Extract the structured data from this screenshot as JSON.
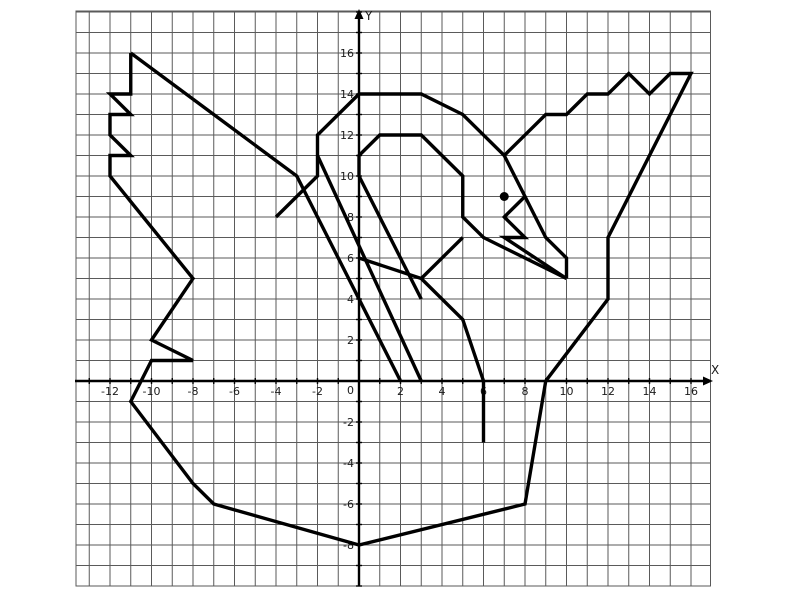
{
  "figure": {
    "width": 800,
    "height": 600,
    "background": "#ffffff",
    "drawing_color": "#000000",
    "grid_color": "#5a5a5a",
    "axis_color": "#000000",
    "label_color": "#1a1a1a"
  },
  "chart_data": {
    "type": "line",
    "title": "",
    "xlabel": "X",
    "ylabel": "Y",
    "origin_label": "0",
    "grid": true,
    "xlim": [
      -13.6,
      17
    ],
    "ylim": [
      -10,
      18
    ],
    "origin_px": [
      359,
      381
    ],
    "unit_px_x": 20.75,
    "unit_px_y": 20.5,
    "grid_box_px": {
      "left": 76,
      "right": 710.5,
      "top": 11,
      "bottom": 586
    },
    "x_tick_step": 1,
    "y_tick_step": 1,
    "x_tick_labels": [
      -12,
      -10,
      -8,
      -6,
      -4,
      -2,
      2,
      4,
      6,
      8,
      10,
      12,
      14,
      16
    ],
    "y_tick_labels": [
      -8,
      -6,
      -4,
      -2,
      2,
      4,
      6,
      8,
      10,
      12,
      14,
      16
    ],
    "series": [
      {
        "name": "main-outline",
        "points": [
          [
            -11,
            16
          ],
          [
            -11,
            14
          ],
          [
            -12,
            14
          ],
          [
            -11,
            13
          ],
          [
            -12,
            13
          ],
          [
            -12,
            12
          ],
          [
            -11,
            11
          ],
          [
            -12,
            11
          ],
          [
            -12,
            10
          ],
          [
            -8,
            5
          ],
          [
            -10,
            2
          ],
          [
            -8,
            1
          ],
          [
            -10,
            1
          ],
          [
            -11,
            -1
          ],
          [
            -8,
            -5
          ],
          [
            -7,
            -6
          ],
          [
            0,
            -8
          ],
          [
            8,
            -6
          ],
          [
            9,
            0
          ],
          [
            12,
            4
          ],
          [
            12,
            7
          ],
          [
            16,
            15
          ],
          [
            15,
            15
          ],
          [
            14,
            14
          ],
          [
            13,
            15
          ],
          [
            12,
            14
          ],
          [
            11,
            14
          ],
          [
            10,
            13
          ],
          [
            9,
            13
          ],
          [
            7,
            11
          ],
          [
            5,
            13
          ],
          [
            3,
            14
          ],
          [
            0,
            14
          ],
          [
            -2,
            12
          ],
          [
            -2,
            10
          ],
          [
            -4,
            8
          ]
        ]
      },
      {
        "name": "left-wing-edge",
        "points": [
          [
            -11,
            16
          ],
          [
            -3,
            10
          ],
          [
            2,
            0
          ]
        ]
      },
      {
        "name": "neck-back-line",
        "points": [
          [
            -2,
            11
          ],
          [
            3,
            0
          ]
        ]
      },
      {
        "name": "neck-front-line",
        "points": [
          [
            3,
            4
          ],
          [
            0,
            10
          ],
          [
            0,
            11
          ],
          [
            1,
            12
          ],
          [
            3,
            12
          ],
          [
            5,
            10
          ],
          [
            5,
            8
          ],
          [
            6,
            7
          ],
          [
            10,
            5
          ]
        ]
      },
      {
        "name": "head-outer-line",
        "points": [
          [
            7,
            11
          ],
          [
            8,
            9
          ],
          [
            9,
            7
          ],
          [
            10,
            6
          ],
          [
            10,
            5
          ]
        ]
      },
      {
        "name": "beak",
        "points": [
          [
            8,
            9
          ],
          [
            7,
            8
          ],
          [
            8,
            7
          ],
          [
            7,
            7
          ],
          [
            10,
            5
          ]
        ]
      },
      {
        "name": "far-wing",
        "points": [
          [
            0,
            6
          ],
          [
            3,
            5
          ],
          [
            5,
            3
          ],
          [
            6,
            0
          ],
          [
            6,
            -3
          ]
        ]
      },
      {
        "name": "far-wing-tip",
        "points": [
          [
            3,
            5
          ],
          [
            5,
            7
          ]
        ]
      }
    ],
    "eye_point": [
      7,
      9
    ],
    "line_width_px": 3.4,
    "eye_radius_px": 4.5
  }
}
